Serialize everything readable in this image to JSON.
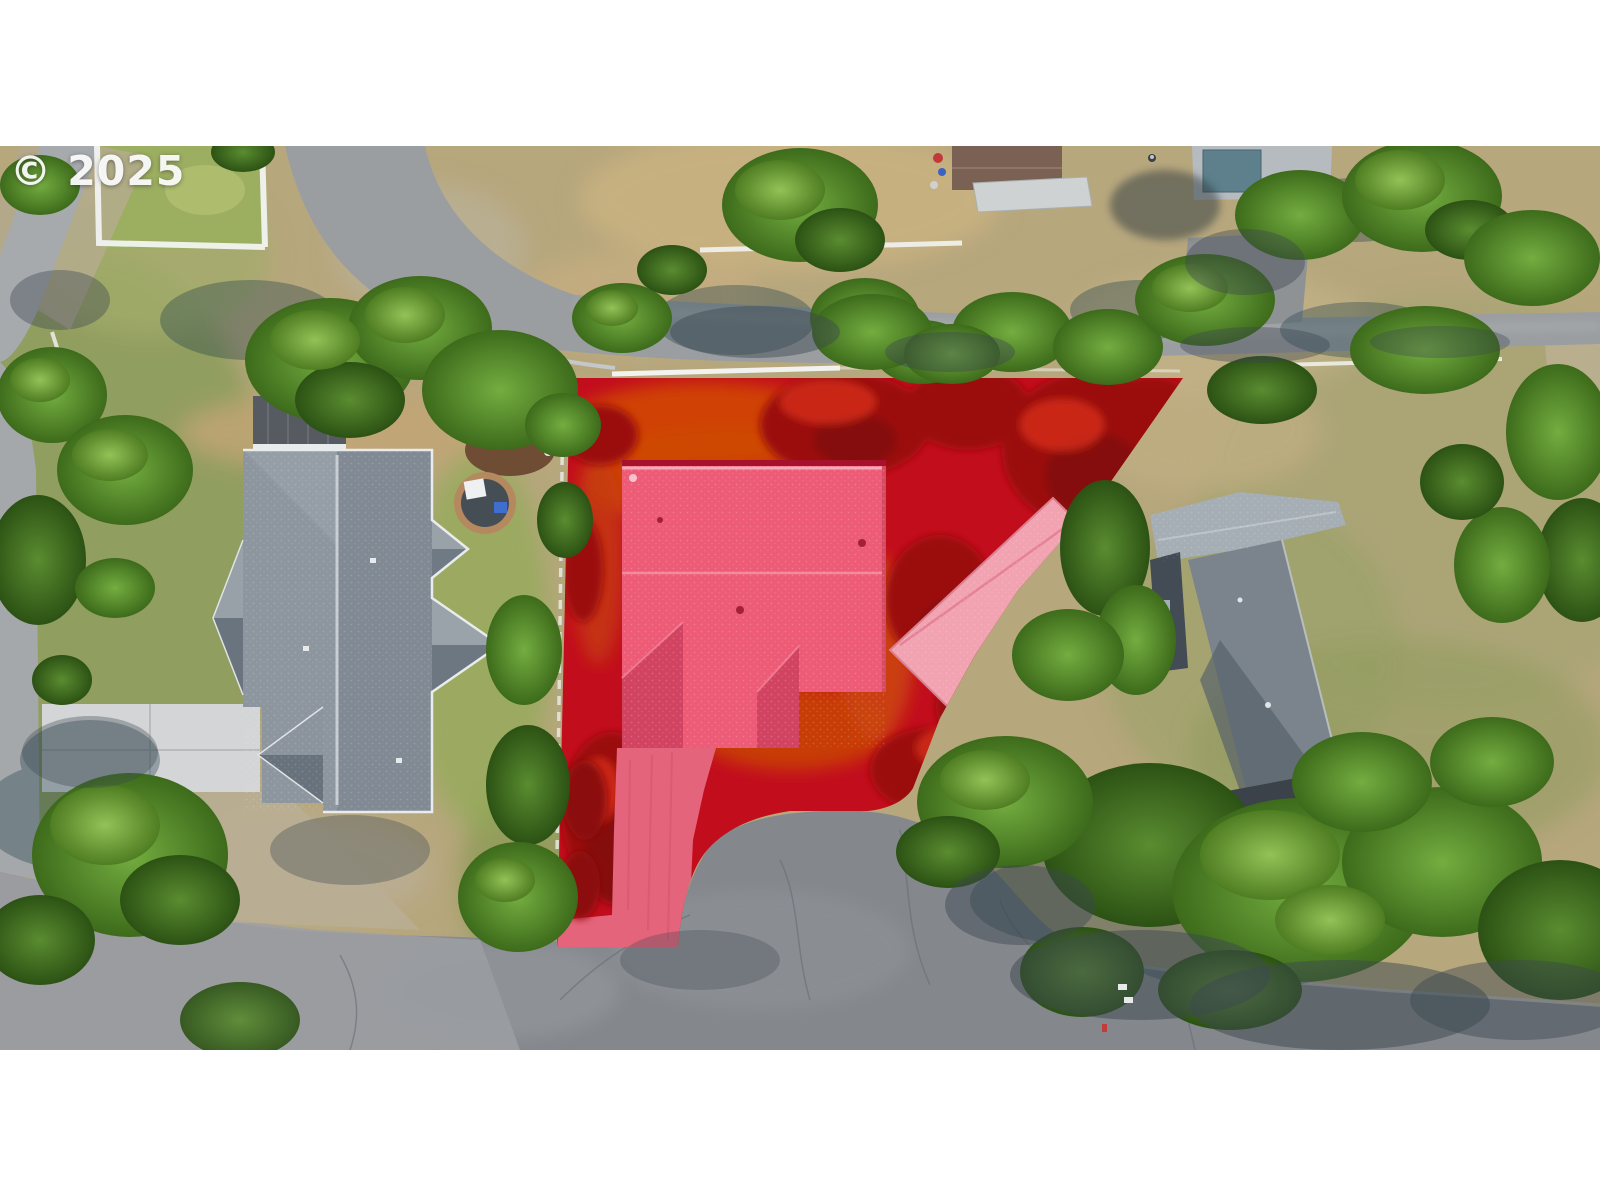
{
  "watermark": {
    "text": "© 2025"
  },
  "photo": {
    "kind": "aerial-drone-photograph",
    "subject": "residential lot highlighted with red property-boundary overlay",
    "letterbox_color": "#ffffff",
    "photo_area": {
      "top": 146,
      "bottom": 1050,
      "width": 1600
    }
  },
  "palette": {
    "overlay_red": "#c20d1d",
    "overlay_tree_red": "#9b0e10",
    "overlay_ground_orange": "#cc4708",
    "subject_roof_pink": "#ed5b76",
    "carport_pink": "#f2a3b1",
    "driveway_pink": "#e4647c",
    "asphalt_dark": "#84888d",
    "asphalt_light": "#a5a8ab",
    "concrete": "#d3d5d6",
    "neighbor_roof_gray": "#8d959e",
    "tree_green": "#5a8c30",
    "dry_grass_tan": "#b7a77d",
    "fence_white": "#f2f3f1"
  },
  "scene": {
    "subject_lot_label": "highlighted property",
    "subject_house_label": "subject house roof",
    "carport_label": "carport",
    "left_house_label": "west neighbor house",
    "right_house_label": "east neighbor house"
  }
}
